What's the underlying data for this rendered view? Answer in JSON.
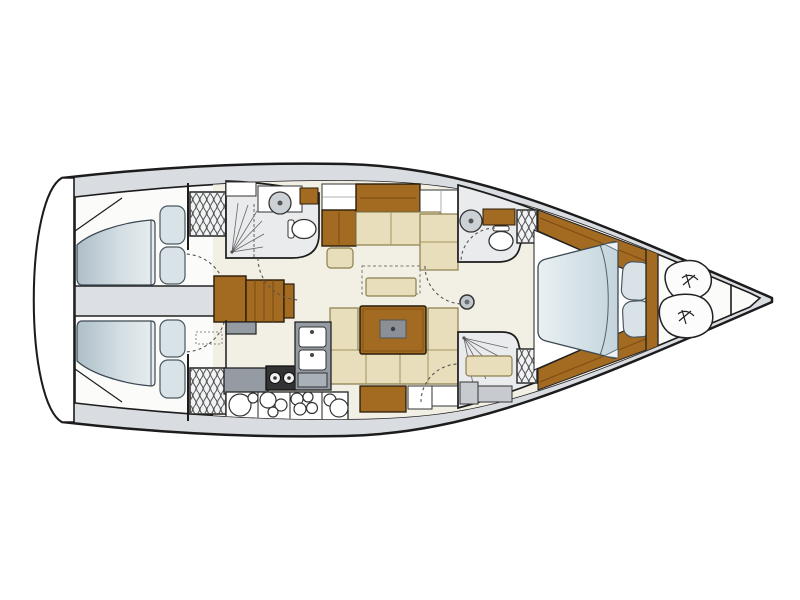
{
  "image": {
    "type": "yacht-interior-floorplan",
    "view": "top-down",
    "orientation": "bow-right",
    "background": "#ffffff"
  },
  "palette": {
    "hull_outline": "#1c1c1c",
    "deck": "#d9dce1",
    "sole_white": "#fbfbf9",
    "sole_cream": "#f2efe4",
    "compartment_floor": "#e9ebec",
    "engine_gray": "#dcdfe3",
    "wood": "#a36a21",
    "wood_dark": "#7a4b12",
    "upholstery": "#e8debb",
    "pillow": "#d9e2e7",
    "mattress_light": "#e7eef1",
    "mattress_dark": "#b2c4ce",
    "counter_gray": "#949ba3",
    "counter_gray_light": "#c7cbd0",
    "stove_black": "#333333",
    "fixture_white": "#ffffff",
    "door_arc": "#555555"
  },
  "rooms": [
    {
      "name": "aft-cabin-port",
      "features": [
        "double-berth",
        "two-pillows",
        "hanging-locker",
        "door"
      ]
    },
    {
      "name": "aft-cabin-starboard",
      "features": [
        "double-berth",
        "two-pillows",
        "hanging-locker",
        "door"
      ]
    },
    {
      "name": "engine-compartment",
      "features": [
        "access-hatch"
      ]
    },
    {
      "name": "companionway",
      "features": [
        "wood-steps",
        "landing",
        "lower-step"
      ]
    },
    {
      "name": "aft-head",
      "features": [
        "shower",
        "round-sink",
        "toilet",
        "cabinets",
        "door"
      ]
    },
    {
      "name": "nav-station",
      "features": [
        "chart-table",
        "seat",
        "cabinet"
      ]
    },
    {
      "name": "salon",
      "features": [
        "sideboard",
        "l-settee",
        "folding-bench",
        "u-settee",
        "wood-table"
      ]
    },
    {
      "name": "galley",
      "features": [
        "double-sink",
        "two-burner-stove",
        "counter",
        "plate-stowage"
      ]
    },
    {
      "name": "forward-head",
      "features": [
        "round-sink",
        "toilet",
        "wood-counter",
        "hanging-locker",
        "door"
      ]
    },
    {
      "name": "forward-shower",
      "features": [
        "shower",
        "bench",
        "hanging-locker",
        "door"
      ]
    },
    {
      "name": "forward-cabin",
      "features": [
        "island-double-berth",
        "two-pillows",
        "wood-side-trim",
        "wood-bulkhead"
      ]
    },
    {
      "name": "sail-locker",
      "features": [
        "sail-bag",
        "sail-bag"
      ]
    },
    {
      "name": "anchor-locker",
      "features": [
        "collision-bulkhead"
      ]
    }
  ]
}
